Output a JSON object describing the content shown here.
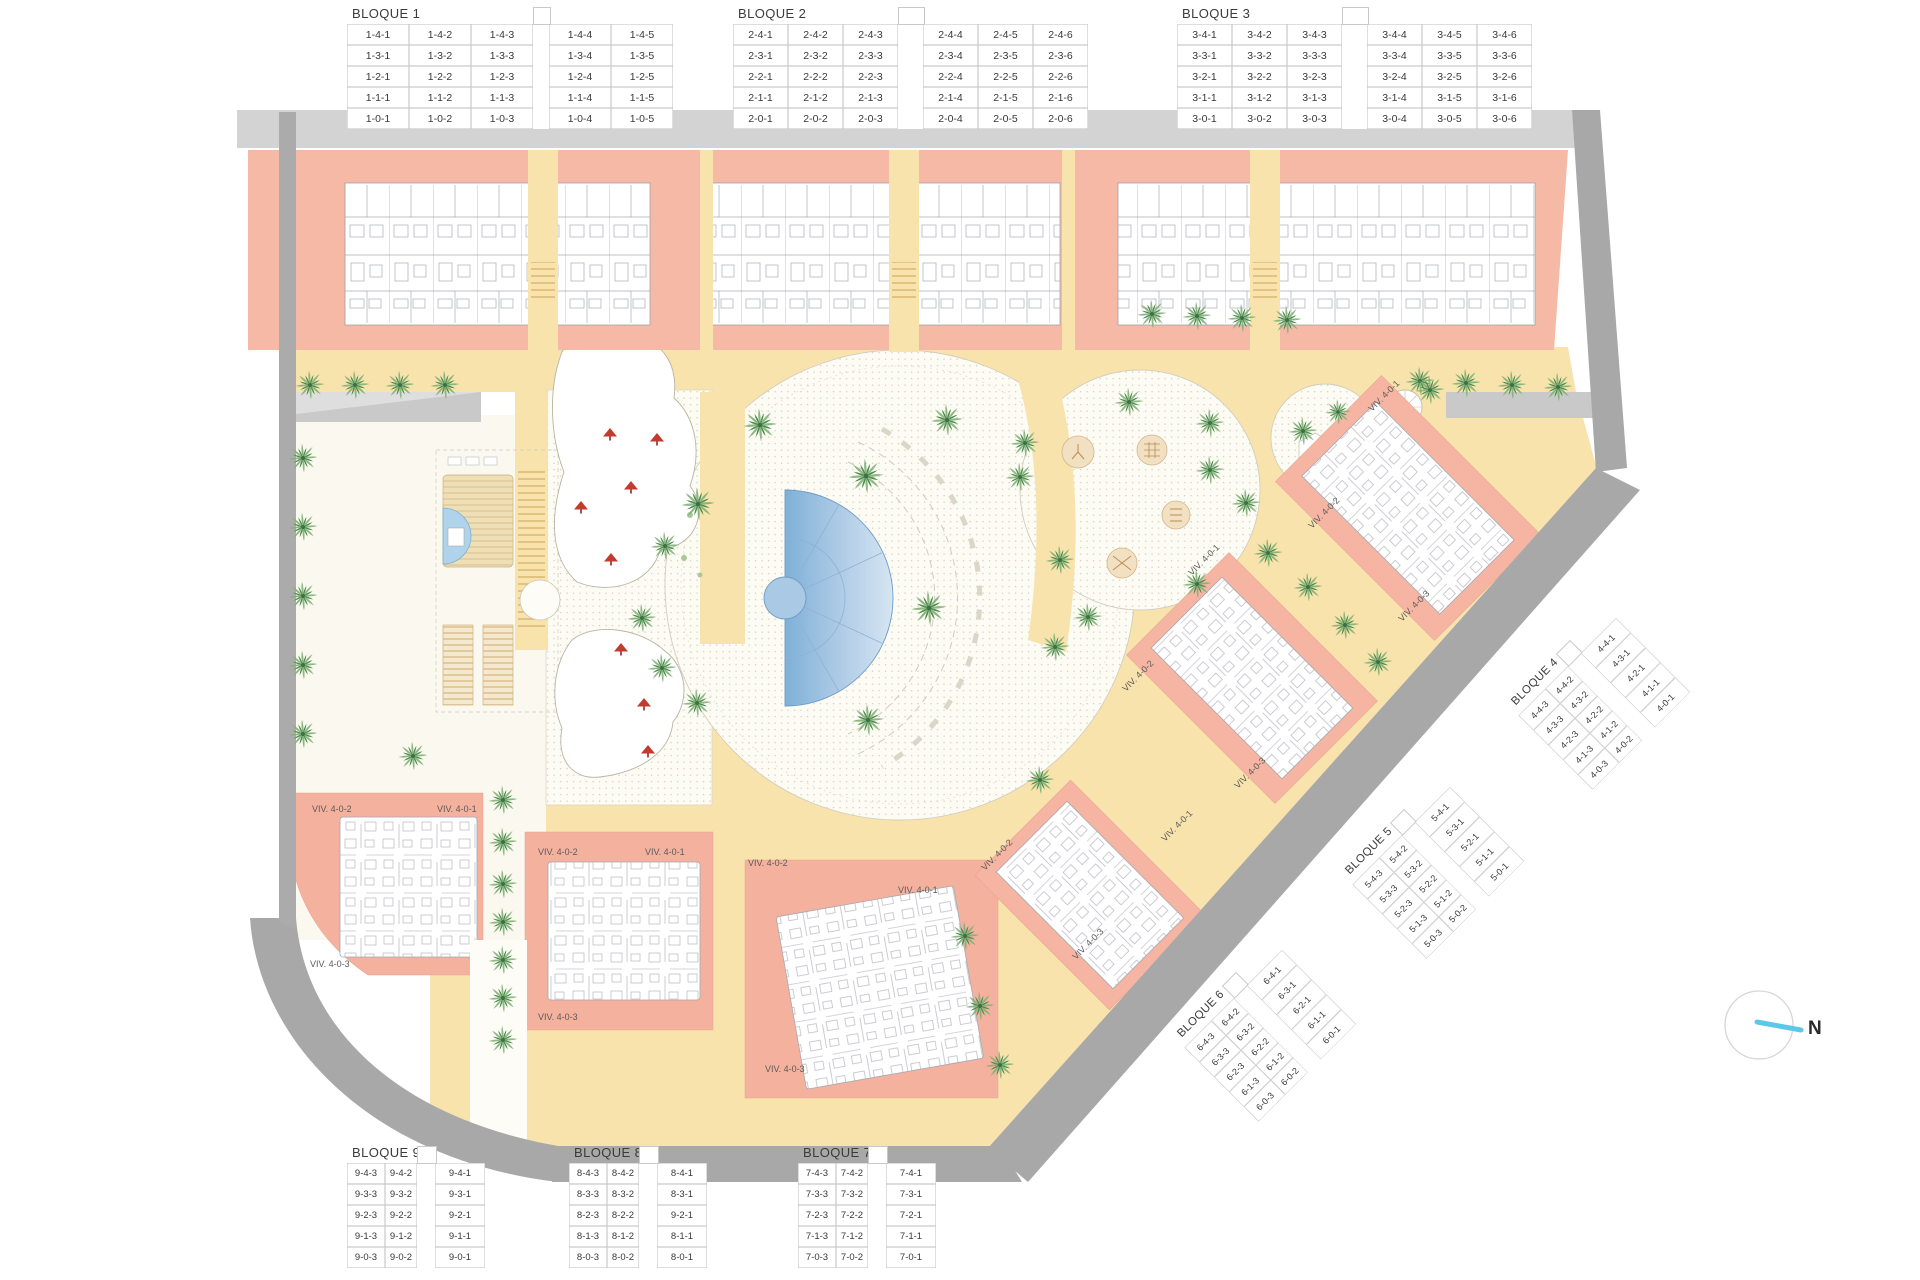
{
  "blocks": {
    "b1": {
      "title": "BLOQUE 1",
      "rows": [
        [
          "1-4-1",
          "1-4-2",
          "1-4-3",
          "",
          "1-4-4",
          "1-4-5"
        ],
        [
          "1-3-1",
          "1-3-2",
          "1-3-3",
          "",
          "1-3-4",
          "1-3-5"
        ],
        [
          "1-2-1",
          "1-2-2",
          "1-2-3",
          "",
          "1-2-4",
          "1-2-5"
        ],
        [
          "1-1-1",
          "1-1-2",
          "1-1-3",
          "",
          "1-1-4",
          "1-1-5"
        ],
        [
          "1-0-1",
          "1-0-2",
          "1-0-3",
          "",
          "1-0-4",
          "1-0-5"
        ]
      ]
    },
    "b2": {
      "title": "BLOQUE 2",
      "rows": [
        [
          "2-4-1",
          "2-4-2",
          "2-4-3",
          "",
          "2-4-4",
          "2-4-5",
          "2-4-6"
        ],
        [
          "2-3-1",
          "2-3-2",
          "2-3-3",
          "",
          "2-3-4",
          "2-3-5",
          "2-3-6"
        ],
        [
          "2-2-1",
          "2-2-2",
          "2-2-3",
          "",
          "2-2-4",
          "2-2-5",
          "2-2-6"
        ],
        [
          "2-1-1",
          "2-1-2",
          "2-1-3",
          "",
          "2-1-4",
          "2-1-5",
          "2-1-6"
        ],
        [
          "2-0-1",
          "2-0-2",
          "2-0-3",
          "",
          "2-0-4",
          "2-0-5",
          "2-0-6"
        ]
      ]
    },
    "b3": {
      "title": "BLOQUE 3",
      "rows": [
        [
          "3-4-1",
          "3-4-2",
          "3-4-3",
          "",
          "3-4-4",
          "3-4-5",
          "3-4-6"
        ],
        [
          "3-3-1",
          "3-3-2",
          "3-3-3",
          "",
          "3-3-4",
          "3-3-5",
          "3-3-6"
        ],
        [
          "3-2-1",
          "3-2-2",
          "3-2-3",
          "",
          "3-2-4",
          "3-2-5",
          "3-2-6"
        ],
        [
          "3-1-1",
          "3-1-2",
          "3-1-3",
          "",
          "3-1-4",
          "3-1-5",
          "3-1-6"
        ],
        [
          "3-0-1",
          "3-0-2",
          "3-0-3",
          "",
          "3-0-4",
          "3-0-5",
          "3-0-6"
        ]
      ]
    },
    "b4": {
      "title": "BLOQUE 4",
      "rows": [
        [
          "4-4-3",
          "4-4-2",
          "",
          "4-4-1"
        ],
        [
          "4-3-3",
          "4-3-2",
          "",
          "4-3-1"
        ],
        [
          "4-2-3",
          "4-2-2",
          "",
          "4-2-1"
        ],
        [
          "4-1-3",
          "4-1-2",
          "",
          "4-1-1"
        ],
        [
          "4-0-3",
          "4-0-2",
          "",
          "4-0-1"
        ]
      ]
    },
    "b5": {
      "title": "BLOQUE 5",
      "rows": [
        [
          "5-4-3",
          "5-4-2",
          "",
          "5-4-1"
        ],
        [
          "5-3-3",
          "5-3-2",
          "",
          "5-3-1"
        ],
        [
          "5-2-3",
          "5-2-2",
          "",
          "5-2-1"
        ],
        [
          "5-1-3",
          "5-1-2",
          "",
          "5-1-1"
        ],
        [
          "5-0-3",
          "5-0-2",
          "",
          "5-0-1"
        ]
      ]
    },
    "b6": {
      "title": "BLOQUE 6",
      "rows": [
        [
          "6-4-3",
          "6-4-2",
          "",
          "6-4-1"
        ],
        [
          "6-3-3",
          "6-3-2",
          "",
          "6-3-1"
        ],
        [
          "6-2-3",
          "6-2-2",
          "",
          "6-2-1"
        ],
        [
          "6-1-3",
          "6-1-2",
          "",
          "6-1-1"
        ],
        [
          "6-0-3",
          "6-0-2",
          "",
          "6-0-1"
        ]
      ]
    },
    "b7": {
      "title": "BLOQUE 7",
      "rows": [
        [
          "7-4-3",
          "7-4-2",
          "",
          "7-4-1"
        ],
        [
          "7-3-3",
          "7-3-2",
          "",
          "7-3-1"
        ],
        [
          "7-2-3",
          "7-2-2",
          "",
          "7-2-1"
        ],
        [
          "7-1-3",
          "7-1-2",
          "",
          "7-1-1"
        ],
        [
          "7-0-3",
          "7-0-2",
          "",
          "7-0-1"
        ]
      ]
    },
    "b8": {
      "title": "BLOQUE 8",
      "rows": [
        [
          "8-4-3",
          "8-4-2",
          "",
          "8-4-1"
        ],
        [
          "8-3-3",
          "8-3-2",
          "",
          "8-3-1"
        ],
        [
          "8-2-3",
          "8-2-2",
          "",
          "9-2-1"
        ],
        [
          "8-1-3",
          "8-1-2",
          "",
          "8-1-1"
        ],
        [
          "8-0-3",
          "8-0-2",
          "",
          "8-0-1"
        ]
      ]
    },
    "b9": {
      "title": "BLOQUE 9",
      "rows": [
        [
          "9-4-3",
          "9-4-2",
          "",
          "9-4-1"
        ],
        [
          "9-3-3",
          "9-3-2",
          "",
          "9-3-1"
        ],
        [
          "9-2-3",
          "9-2-2",
          "",
          "9-2-1"
        ],
        [
          "9-1-3",
          "9-1-2",
          "",
          "9-1-1"
        ],
        [
          "9-0-3",
          "9-0-2",
          "",
          "9-0-1"
        ]
      ]
    }
  },
  "map": {
    "compass_label": "N",
    "colors": {
      "building_pink": "#f5b9a5",
      "path_yellow": "#f9e3ad",
      "road_dark": "#a8a8a8",
      "road_light": "#d3d3d3",
      "pool_blue": "#7fb0d8",
      "palm_green": "#4e8b52"
    },
    "viv_labels": [
      {
        "text": "VIV. 4-0-2"
      },
      {
        "text": "VIV. 4-0-1"
      },
      {
        "text": "VIV. 4-0-3"
      },
      {
        "text": "VIV. 4-0-2"
      },
      {
        "text": "VIV. 4-0-1"
      },
      {
        "text": "VIV. 4-0-3"
      },
      {
        "text": "VIV. 4-0-2"
      },
      {
        "text": "VIV. 4-0-1"
      },
      {
        "text": "VIV. 4-0-3"
      },
      {
        "text": "VIV. 4-0-1"
      },
      {
        "text": "VIV. 4-0-2"
      },
      {
        "text": "VIV. 4-0-3"
      },
      {
        "text": "VIV. 4-0-1"
      },
      {
        "text": "VIV. 4-0-2"
      },
      {
        "text": "VIV. 4-0-3"
      },
      {
        "text": "VIV. 4-0-2"
      },
      {
        "text": "VIV. 4-0-1"
      },
      {
        "text": "VIV. 4-0-3"
      }
    ]
  }
}
